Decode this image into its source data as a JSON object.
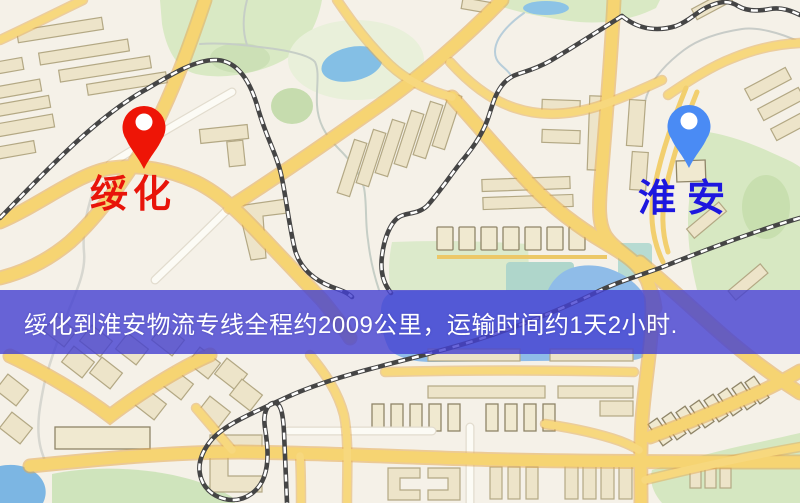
{
  "map": {
    "origin": {
      "label": "绥化",
      "color": "#E8140A"
    },
    "destination": {
      "label": "淮安",
      "color": "#1D17DF"
    }
  },
  "banner": {
    "text": "绥化到淮安物流专线全程约2009公里，运输时间约1天2小时.",
    "background": "#4340D1",
    "text_color": "#FFFFFF"
  },
  "icons": {
    "origin_pin": "red-map-pin-icon",
    "destination_pin": "blue-map-pin-icon"
  },
  "colors": {
    "background": "#F5F1E8",
    "road_yellow": "#F6D472",
    "road_casing": "#E3AA52",
    "road_white": "#FCFBF5",
    "park_green": "#D7E8C2",
    "water_blue": "#84BFE5",
    "railway_dark": "#454545",
    "building_fill": "#EDE4C9",
    "origin_pin": "#EE1506",
    "destination_pin": "#4A8BF4"
  }
}
